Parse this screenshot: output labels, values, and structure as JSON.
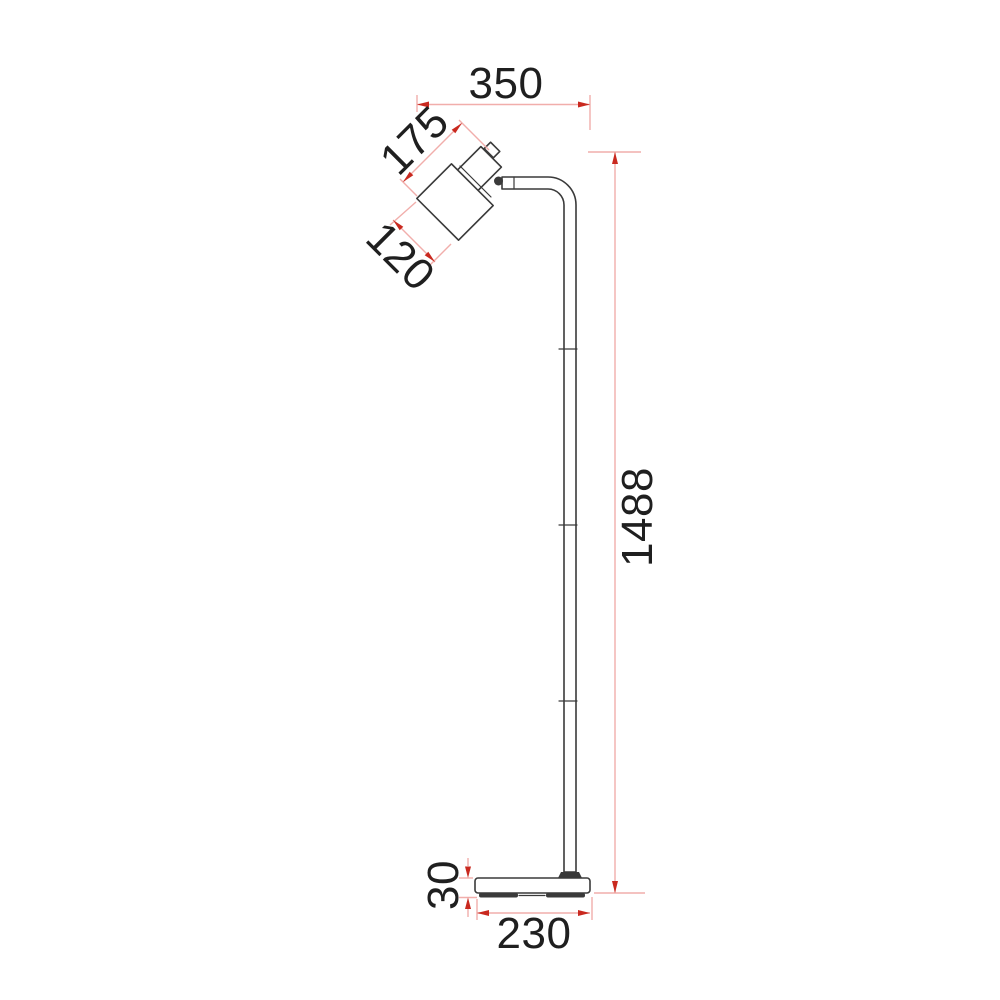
{
  "drawing": {
    "type": "technical-dimension-drawing",
    "subject": "floor lamp side elevation with dimensions (mm)",
    "dimensions": {
      "head_overhang_width": "350",
      "head_assembly_length": "175",
      "shade_diameter": "120",
      "total_height": "1488",
      "base_thickness": "30",
      "base_width": "230"
    },
    "colors": {
      "background": "#ffffff",
      "outline": "#3a3a3a",
      "dim_line": "#f1aeab",
      "dim_arrow": "#c9291f",
      "text": "#1f1f1f"
    }
  }
}
